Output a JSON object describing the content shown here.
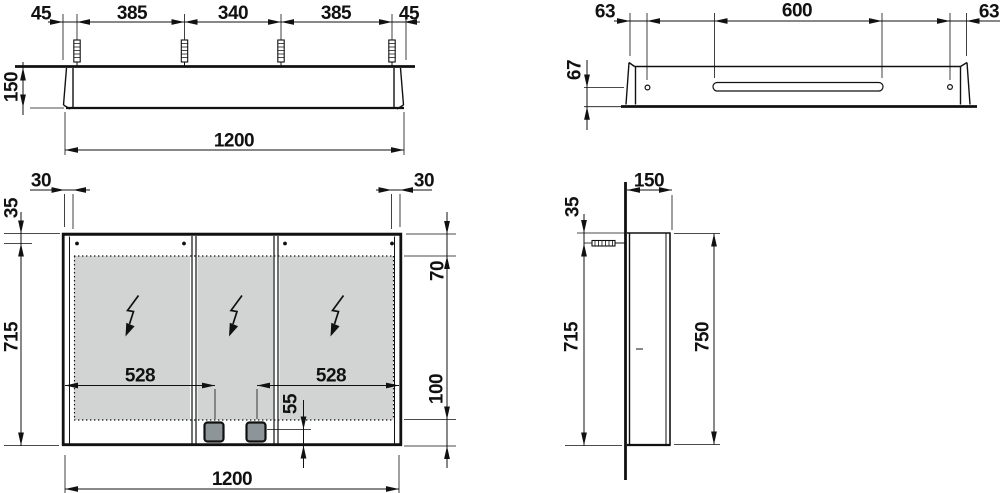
{
  "drawing": {
    "type": "technical-dimension-drawing",
    "subject": "mirror-cabinet",
    "colors": {
      "line": "#111111",
      "mirror_fill": "#d2d4d4",
      "socket_fill": "#8d9598"
    }
  },
  "views": {
    "top": {
      "label": "top-view",
      "dims": {
        "offset_left": "45",
        "span_left": "385",
        "span_center": "340",
        "span_right": "385",
        "offset_right": "45",
        "depth": "150",
        "width": "1200"
      }
    },
    "rail": {
      "label": "mounting-rail-view",
      "dims": {
        "offset_left": "63",
        "slot_length": "600",
        "offset_right": "63",
        "hole_height": "67"
      }
    },
    "front": {
      "label": "front-view",
      "dims": {
        "inset_left": "30",
        "inset_right": "30",
        "top_to_hole": "35",
        "hole_to_bottom": "715",
        "top_to_mirror": "70",
        "mirror_to_bottom": "100",
        "door_left": "528",
        "door_right": "528",
        "socket_offset": "55",
        "width": "1200"
      }
    },
    "side": {
      "label": "side-view",
      "dims": {
        "depth": "150",
        "top_to_screw": "35",
        "screw_to_bottom": "715",
        "height": "750"
      }
    }
  }
}
